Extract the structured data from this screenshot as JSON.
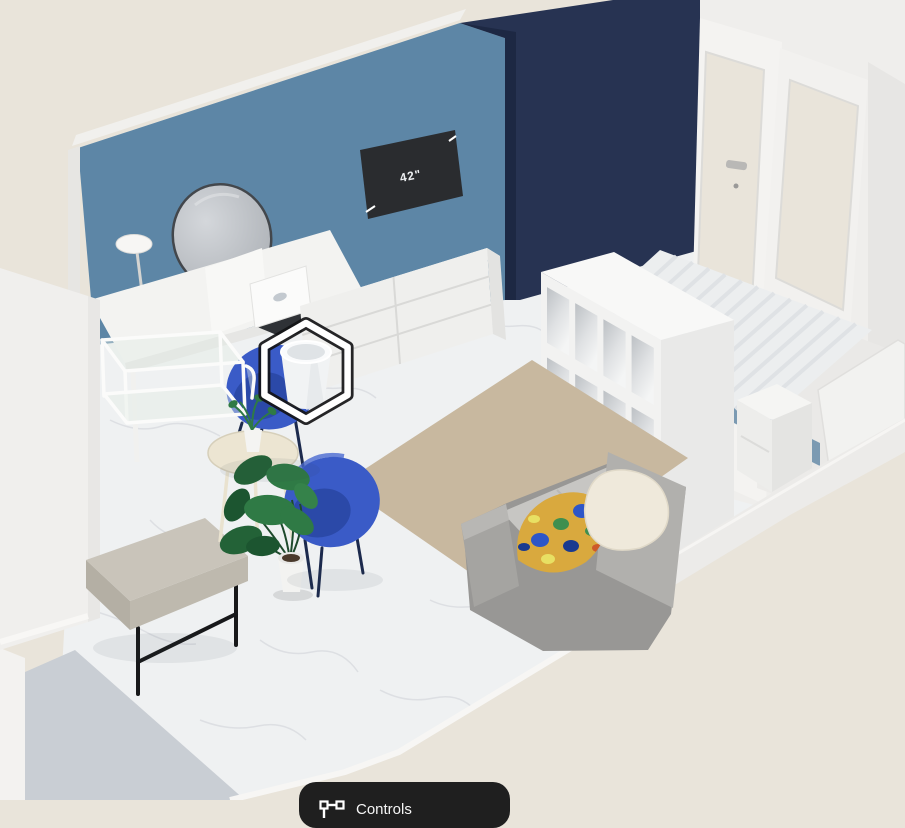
{
  "tv": {
    "size_label": "42\""
  },
  "controls_button": {
    "label": "Controls",
    "icon": "walls-tool-icon"
  },
  "selection": {
    "marker_shape": "hexagon",
    "selected_item": "waste-bin"
  },
  "colors": {
    "bg": "#e9e4da",
    "floor": "#eff1f2",
    "floor_patch": "#c9ced4",
    "wall_blue": "#5d86a6",
    "wall_navy": "#273352",
    "wall_navy_dark": "#1d2843",
    "wall_white": "#efeeec",
    "rug": "#c8b89f",
    "chair_blue": "#3a5bc7",
    "chair_blue_dark": "#2b49a8",
    "sofa_gray": "#989795",
    "bench_gray": "#c9c4ba",
    "bed_base_blue": "#7b9ab2",
    "mattress_white": "#eceeef",
    "plant_green": "#2f7a45",
    "tv_screen": "#2a2c2f",
    "hexagon_ring": "#ffffff",
    "hexagon_ring_edge": "#131416",
    "pillow_yellow": "#d9a93e",
    "button_bg": "#1f1f1f",
    "button_text": "#f5f5f5"
  },
  "scene": {
    "items": [
      "blue-accent-wall",
      "navy-accent-wall",
      "glass-double-door",
      "round-mirror",
      "wall-lamp",
      "tv-42-inch",
      "vanity-desk",
      "laptop",
      "six-drawer-dresser",
      "wire-shelf",
      "waste-bin",
      "blue-tub-chair-1",
      "blue-tub-chair-2",
      "round-side-table",
      "small-plant",
      "monstera-plant",
      "upholstered-bench",
      "cube-shelf-4x4",
      "double-bed",
      "nightstand",
      "headboard-wall",
      "gray-sofa",
      "patterned-pillow",
      "cream-pillow",
      "beige-rug",
      "marble-floor"
    ]
  }
}
